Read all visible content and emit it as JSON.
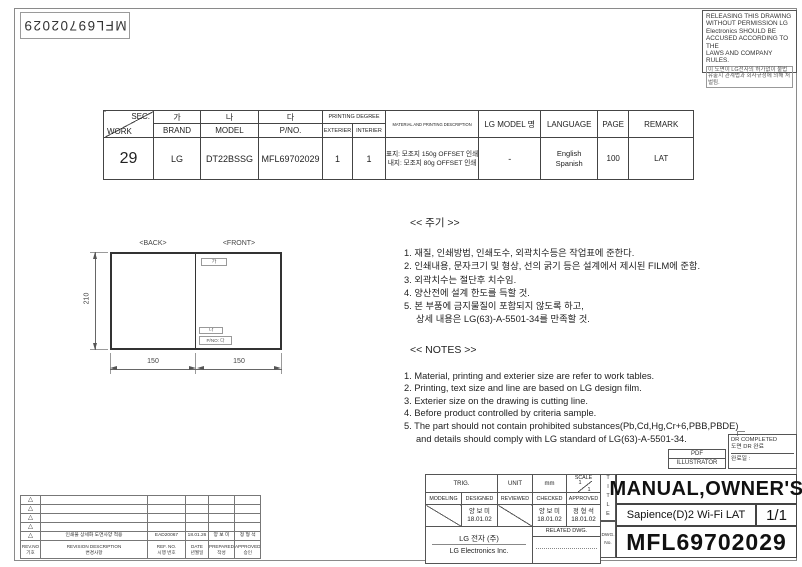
{
  "sheet": {
    "part_no_rotated": "MFL69702029",
    "warning_lines": [
      "RELEASING THIS DRAWING",
      "WITHOUT PERMISSION LG",
      "Electronics SHOULD BE",
      "ACCUSED ACCORDING TO THE",
      "LAWS AND COMPANY RULES.",
      "이 도면이 LG전자의 허가없이 불법",
      "유출시 관계법과 회사규정에 의해 처벌됨."
    ]
  },
  "work_table": {
    "h": {
      "sec": "SEC.",
      "work": "WORK",
      "ga": "가",
      "brand": "BRAND",
      "na": "나",
      "model": "MODEL",
      "da": "다",
      "pno": "P/NO.",
      "printing_degree": "PRINTING DEGREE",
      "exterier": "EXTERIER",
      "interier": "INTERIER",
      "material": "MATERIAL AND PRINTING DESCRIPTION",
      "lg_model": "LG MODEL 명",
      "language": "LANGUAGE",
      "page": "PAGE",
      "remark": "REMARK"
    },
    "row": {
      "work": "29",
      "brand": "LG",
      "model": "DT22BSSG",
      "pno": "MFL69702029",
      "exterier": "1",
      "interier": "1",
      "material1": "표지: 모조지 150g OFFSET 인쇄",
      "material2": "내지: 모조지 80g OFFSET 인쇄",
      "lg_model": "-",
      "language1": "English",
      "language2": "Spanish",
      "page": "100",
      "remark": "LAT"
    }
  },
  "drawing": {
    "back_label": "<BACK>",
    "front_label": "<FRONT>",
    "height_dim": "210",
    "width_left": "150",
    "width_right": "150",
    "ga_box": "가",
    "na_box": "나",
    "pno_box": "P/NO: 다"
  },
  "notes_kr": {
    "title": "<< 주기 >>",
    "lines": [
      "1. 재질, 인쇄방법, 인쇄도수, 외곽치수등은 작업표에 준한다.",
      "2. 인쇄내용, 문자크기 및 형상, 선의 굵기 등은 설계에서 제시된 FILM에 준함.",
      "3. 외곽치수는 절단후 치수임.",
      "4. 양산전에 설계 한도를 득할 것.",
      "5. 본 부품에 금지물질이 포함되지 않도록 하고,",
      "상세 내용은 LG(63)-A-5501-34를 만족할 것."
    ]
  },
  "notes_en": {
    "title": "<< NOTES >>",
    "lines": [
      "1. Material, printing and exterier size are refer to work tables.",
      "2. Printing, text size and line are based on LG design film.",
      "3. Exterier size on the drawing is cutting line.",
      "4. Before product controlled by criteria sample.",
      "5. The part should not contain prohibited substances(Pb,Cd,Hg,Cr+6,PBB,PBDE)",
      "and details should comply with LG standard of LG(63)-A-5501-34."
    ]
  },
  "title_block": {
    "pdf": "PDF",
    "illustrator": "ILLUSTRATOR",
    "dr_completed": "DR COMPLETED",
    "dr_completed_kr": "도면 DR 완료",
    "dr_date_label": "완료일 :",
    "trig": "TRIG.",
    "unit_label": "UNIT",
    "unit_value": "mm",
    "scale_label": "SCALE",
    "scale_num": "1",
    "scale_den": "1",
    "modeling": "MODELING",
    "designed": "DESIGNED",
    "reviewed": "REVIEWED",
    "checked": "CHECKED",
    "approved": "APPROVED",
    "designed_name": "양 보 미",
    "designed_date": "18.01.02",
    "checked_name": "양 보 미",
    "checked_date": "18.01.02",
    "approved_name": "정 형 석",
    "approved_date": "18.01.02",
    "company_kr": "LG 전자    (주)",
    "company_en": "LG Electronics Inc.",
    "related_dwg": "RELATED DWG.",
    "dwg_label": "DWG.",
    "no_label": "No.",
    "title_vertical": "TITLE",
    "title": "MANUAL,OWNER'S",
    "subtitle": "Sapience(D)2 Wi-Fi LAT",
    "sheet_no": "1/1",
    "drawing_no": "MFL69702029"
  },
  "revision": {
    "marker": "△",
    "entry": {
      "desc": "인쇄물 상세화 도면사양 적용",
      "ref": "EAD20067",
      "date": "18.01.26",
      "prepared": "양 보 미",
      "approved": "정 형 석"
    },
    "h": {
      "rev_no": "REV.NO",
      "rev_no_kr": "기호",
      "desc": "REVISION DESCRIPTION",
      "desc_kr": "변경사항",
      "ref": "REF. NO.",
      "ref_kr": "시행 번호",
      "date": "DATE",
      "date_kr": "년월일",
      "prepared": "PREPARED",
      "prepared_kr": "작성",
      "approved": "APPROVED",
      "approved_kr": "승인"
    }
  }
}
